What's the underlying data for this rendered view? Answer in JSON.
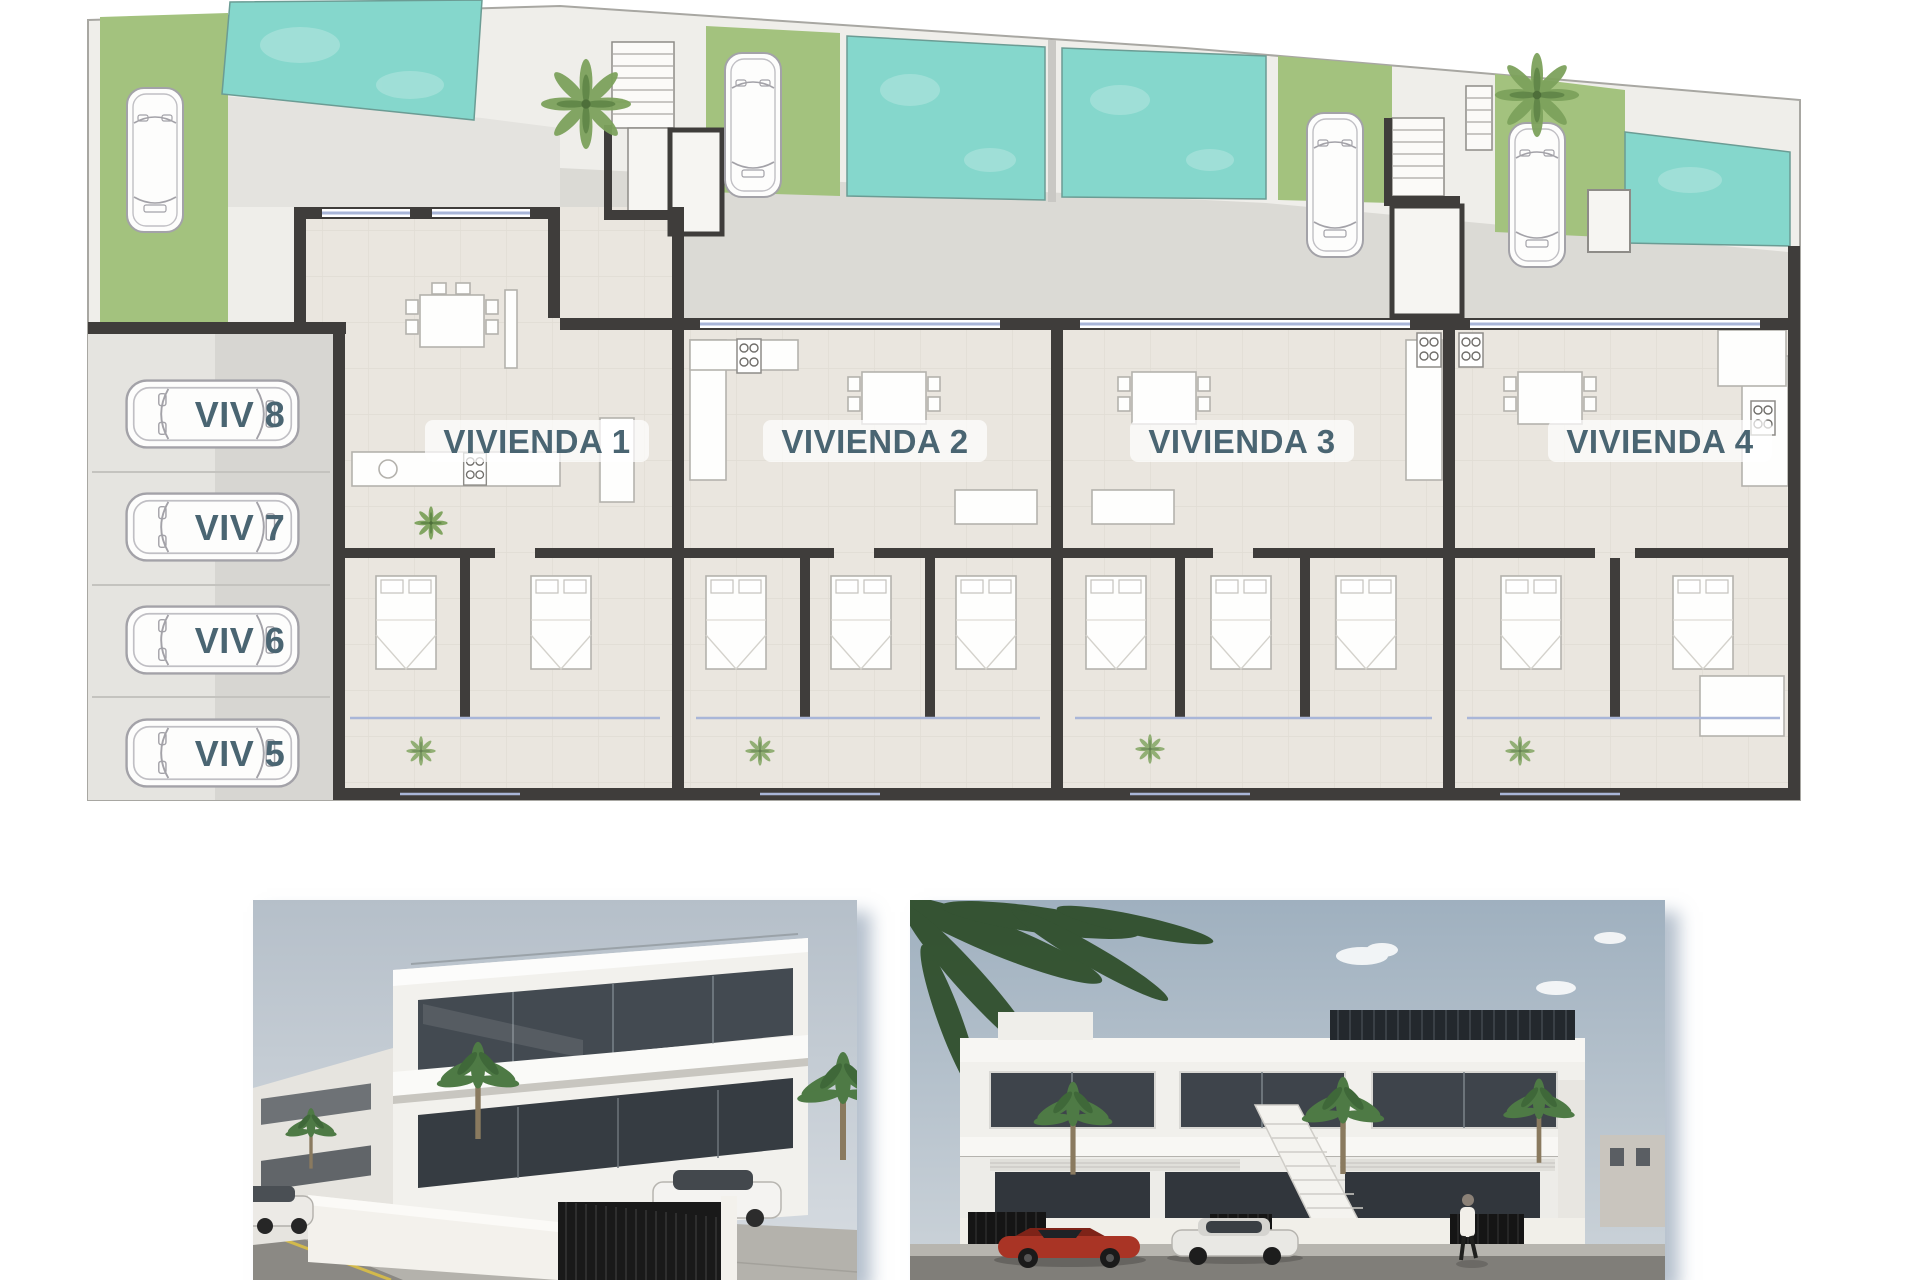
{
  "floor_plan": {
    "units": [
      {
        "label": "VIVIENDA 1"
      },
      {
        "label": "VIVIENDA 2"
      },
      {
        "label": "VIVIENDA 3"
      },
      {
        "label": "VIVIENDA 4"
      }
    ],
    "parking": [
      {
        "label": "VIV 8"
      },
      {
        "label": "VIV 7"
      },
      {
        "label": "VIV 6"
      },
      {
        "label": "VIV 5"
      }
    ],
    "colors": {
      "pool": "#85d7cc",
      "grass": "#a3c27e",
      "wall": "#3f3d3b",
      "floor": "#eae6df",
      "paving": "#efeeea",
      "driveway": "#dbdad5",
      "glazing": "#a9b6d8",
      "label": "#4a6572"
    }
  },
  "renders": {
    "colors": {
      "sky": "#aab8c4",
      "building": "#f2f1ed",
      "glass": "#3c4248",
      "road": "#807e79",
      "red_car": "#a93425",
      "palm": "#3c5a33"
    }
  }
}
